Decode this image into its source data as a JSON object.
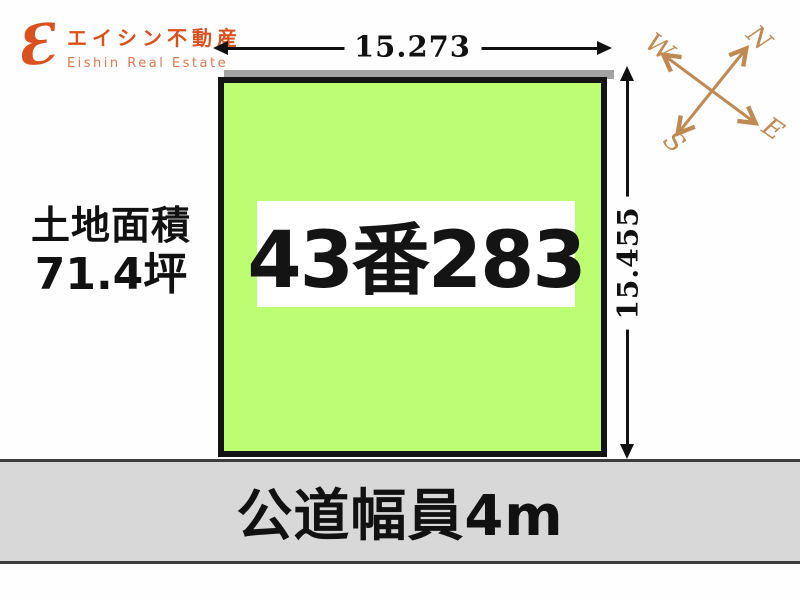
{
  "logo": {
    "mark_glyph": "Ɛ",
    "company_jp": "エイシン不動産",
    "company_en": "Eishin Real Estate",
    "brand_color": "#d9511e"
  },
  "dimensions": {
    "width_label": "15.273",
    "height_label": "15.455"
  },
  "parcel": {
    "lot_number": "43番283",
    "fill_color": "#bdfd72"
  },
  "area": {
    "label": "土地面積",
    "value": "71.4坪"
  },
  "road": {
    "label": "公道幅員4m",
    "fill_color": "#d8d8d8"
  },
  "compass": {
    "north": "N",
    "east": "E",
    "south": "S",
    "west": "W",
    "color": "#bf8a52"
  }
}
